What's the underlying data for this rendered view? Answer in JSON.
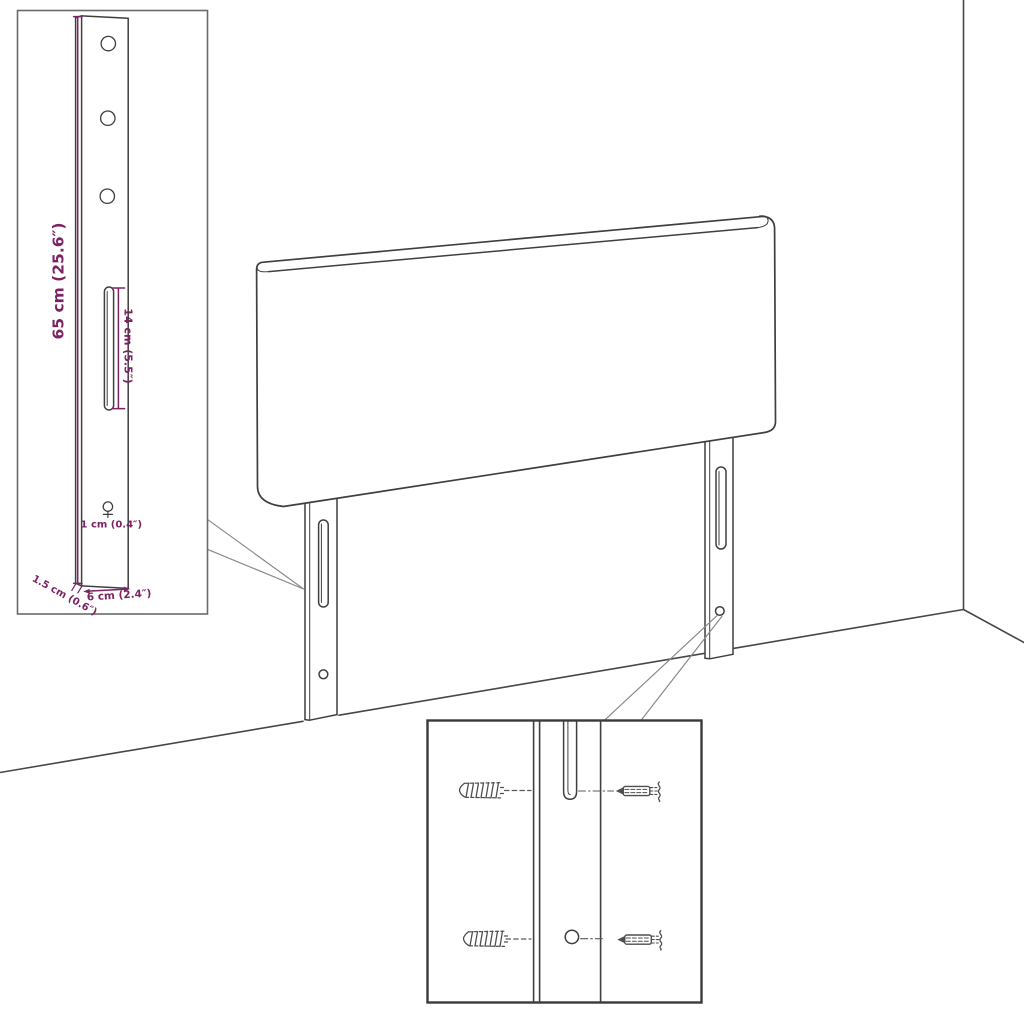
{
  "colors": {
    "line": "#3f3f3f",
    "dimension": "#7d2363",
    "callout": "#8a8a8a",
    "background": "#ffffff"
  },
  "labels": {
    "bracket_height": "65 cm (25.6″)",
    "slot_length": "14 cm (5.5″)",
    "hole_diameter": "1 cm (0.4″)",
    "bracket_depth": "1.5 cm (0.6″)",
    "bracket_width": "6 cm (2.4″)"
  }
}
